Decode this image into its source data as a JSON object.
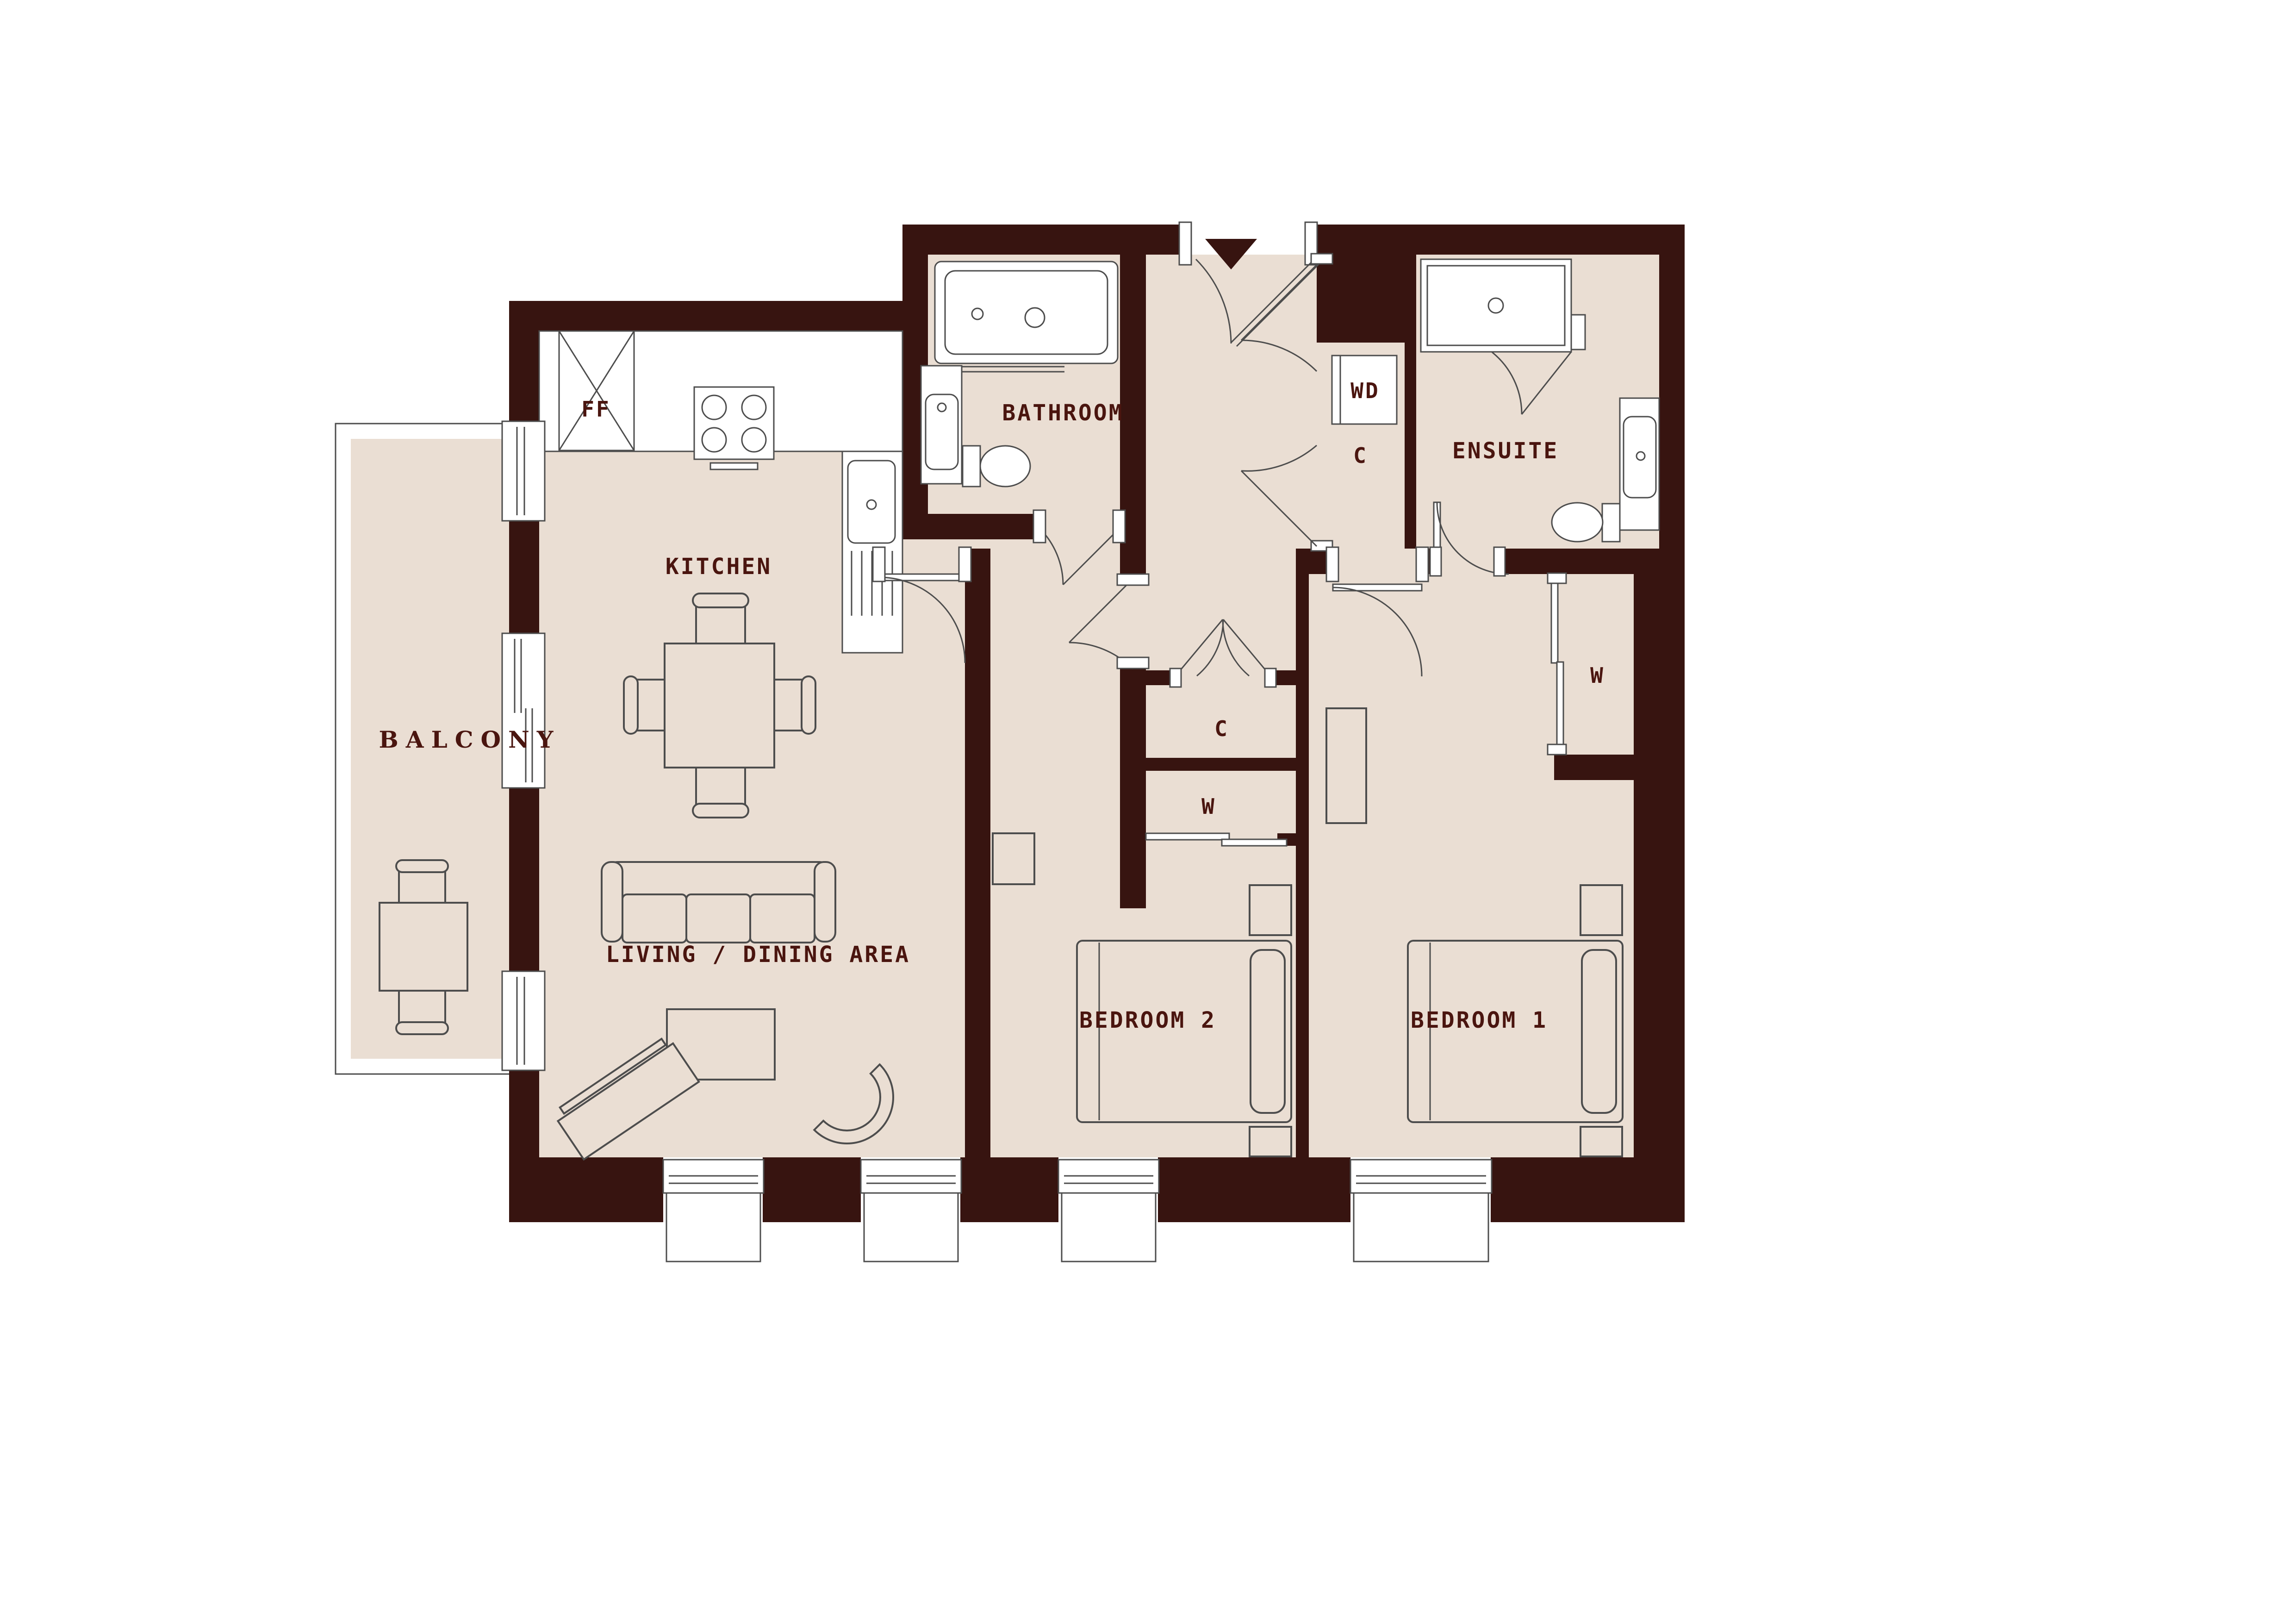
{
  "plan": {
    "title": "Two bedroom apartment floor plan",
    "rooms": {
      "kitchen": "KITCHEN",
      "bathroom": "BATHROOM",
      "ensuite": "ENSUITE",
      "bedroom1": "BEDROOM 1",
      "bedroom2": "BEDROOM 2",
      "living": "LIVING / DINING AREA",
      "balcony": "BALCONY"
    },
    "closets": {
      "entrance_closet": "C",
      "mid_cupboard": "C",
      "mid_wardrobe": "W",
      "bedroom1_wardrobe": "W"
    },
    "appliances": {
      "fridge_freezer": "FF",
      "washer_dryer": "WD"
    }
  },
  "colors": {
    "wall": "#371410",
    "floor": "#EADED3",
    "outline": "#4d4d4d",
    "label": "#4A150F",
    "fixture": "#FFFFFF",
    "background": "#FFFFFF"
  }
}
